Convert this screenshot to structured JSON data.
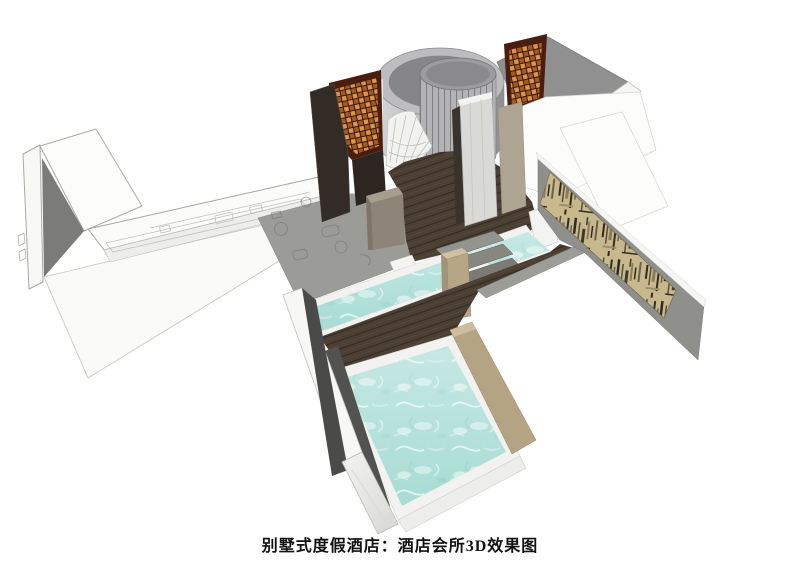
{
  "caption": {
    "text": "别墅式度假酒店：酒店会所3D效果图"
  },
  "colors": {
    "background": "#ffffff",
    "water": "#a7dcd4",
    "wood": "#4b3f33",
    "tan_ledge": "#b5a483",
    "tan_post": "#b6a686",
    "gray_wall": "#8f8f8b",
    "deck_fascia": "#9c9c98",
    "art_panel": "#c7b88e",
    "lattice_orange": "#c8833f",
    "lattice_frame": "#4a1d11",
    "dark_wall": "#332b25",
    "plan_floor": "#9b9b97",
    "roof_gray": "#909090",
    "marble": "#d9d9d5",
    "step_gray": "#8a8a84",
    "white_wall": "#f7f7f5",
    "caption_text": "#111111"
  }
}
